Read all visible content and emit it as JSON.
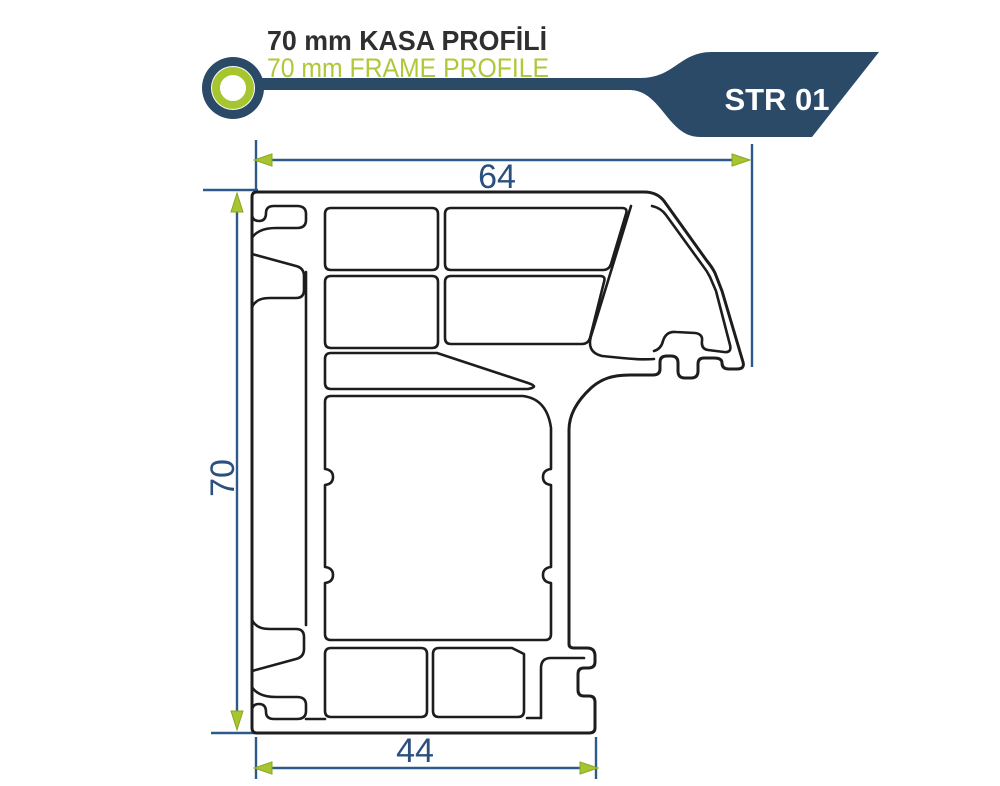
{
  "header": {
    "title_tr": "70 mm KASA PROFİLİ",
    "title_en": "70 mm FRAME PROFILE",
    "product_code": "STR 01"
  },
  "drawing": {
    "type": "technical-profile-cross-section",
    "dimension_top_width": "64",
    "dimension_left_height": "70",
    "dimension_bottom_width": "44"
  },
  "colors": {
    "navy": "#2b4a68",
    "dim_blue": "#2d5a88",
    "dim_text": "#2b4f7e",
    "green": "#a6c52f",
    "green_dark": "#8aa626",
    "green_text": "#afc838",
    "title_text": "#2f2f2f",
    "line_dark": "#1d1d20",
    "white": "#ffffff"
  }
}
